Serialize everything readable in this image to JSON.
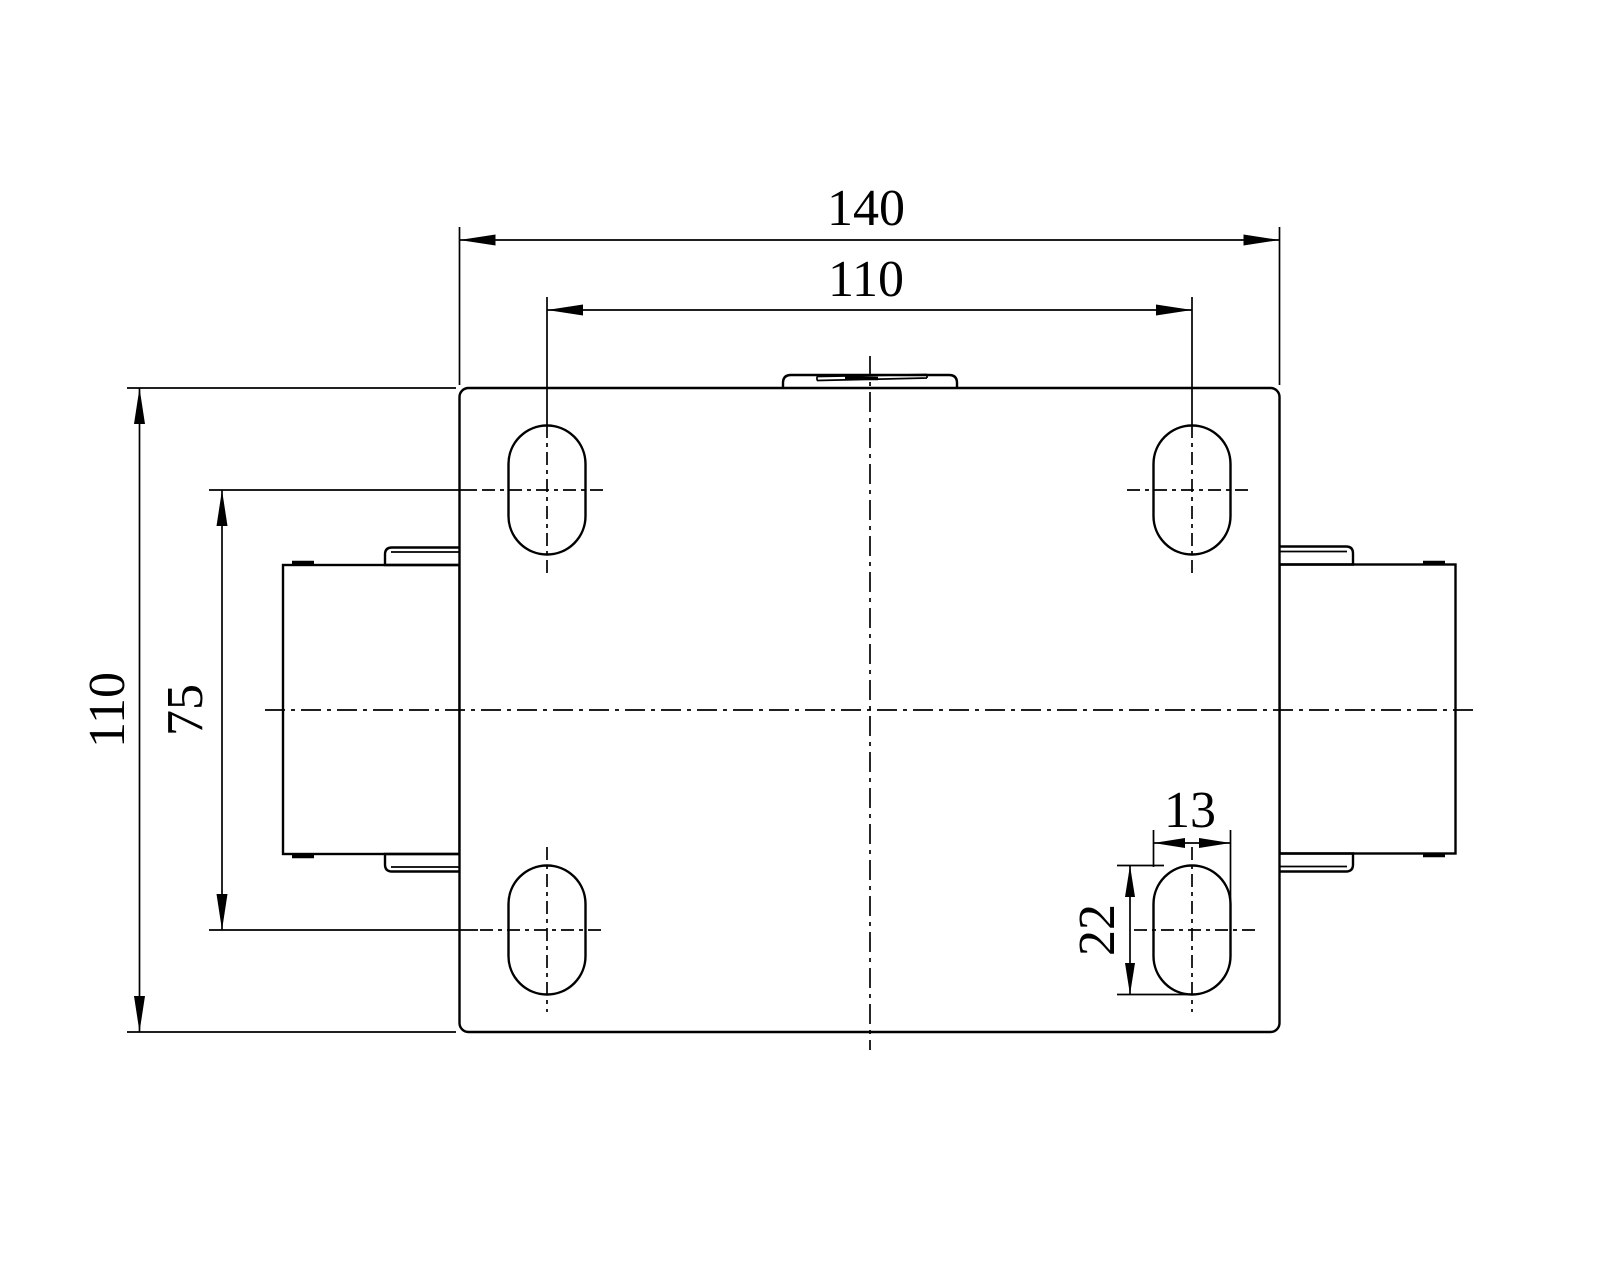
{
  "page": {
    "background_color": "#ffffff",
    "line_color": "#000000"
  },
  "drawing": {
    "kind": "engineering-dimension-drawing",
    "view": "caster-mounting-plate-top-view",
    "units_implied": "mm"
  },
  "dims": {
    "overall_width": "140",
    "hole_pitch_x": "110",
    "overall_depth": "110",
    "hole_pitch_y": "75",
    "slot_width": "13",
    "slot_length": "22"
  }
}
